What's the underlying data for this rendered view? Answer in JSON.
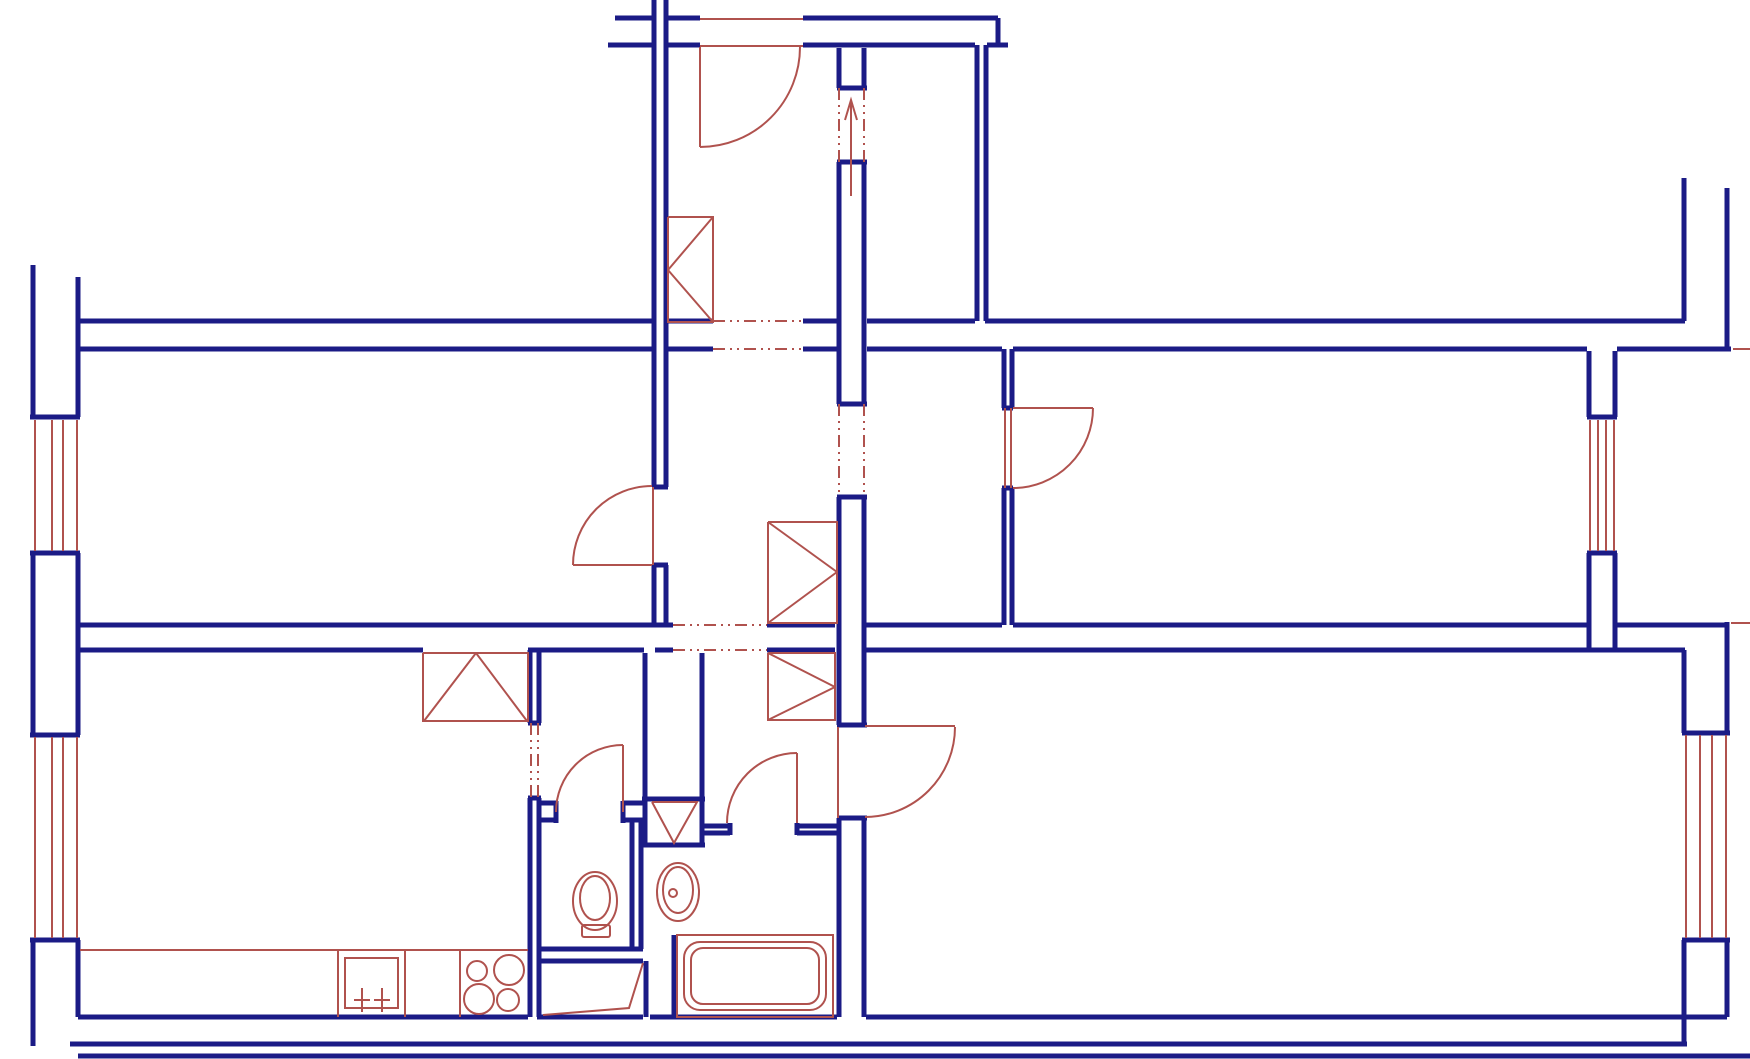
{
  "canvas": {
    "w": 1750,
    "h": 1059,
    "background": "#ffffff"
  },
  "palette": {
    "wall_color": "#1b1b86",
    "thin_color": "#b0524e",
    "wall_width": 5,
    "thin_width": 2,
    "dash_pattern": "12 5 2 5 2 5"
  },
  "plan": {
    "walls_h": [
      [
        18,
        615,
        652
      ],
      [
        18,
        668,
        700
      ],
      [
        18,
        803,
        998
      ],
      [
        45,
        608,
        652
      ],
      [
        45,
        668,
        700
      ],
      [
        45,
        803,
        975
      ],
      [
        45,
        987,
        1008
      ],
      [
        321,
        80,
        652
      ],
      [
        321,
        668,
        713
      ],
      [
        321,
        803,
        837
      ],
      [
        321,
        867,
        975
      ],
      [
        321,
        985,
        1685
      ],
      [
        349,
        80,
        652
      ],
      [
        349,
        668,
        713
      ],
      [
        349,
        803,
        837
      ],
      [
        349,
        867,
        1002
      ],
      [
        349,
        1013,
        1587
      ],
      [
        349,
        1617,
        1731
      ],
      [
        417,
        30,
        80
      ],
      [
        553,
        30,
        80
      ],
      [
        735,
        30,
        80
      ],
      [
        940,
        30,
        80
      ],
      [
        417,
        1587,
        1617
      ],
      [
        553,
        1587,
        1617
      ],
      [
        733,
        1682,
        1730
      ],
      [
        940,
        1682,
        1730
      ],
      [
        487,
        652,
        668
      ],
      [
        565,
        652,
        668
      ],
      [
        408,
        1002,
        1013
      ],
      [
        488,
        1002,
        1013
      ],
      [
        88,
        837,
        867
      ],
      [
        162,
        837,
        867
      ],
      [
        404,
        837,
        867
      ],
      [
        497,
        837,
        867
      ],
      [
        725,
        837,
        867
      ],
      [
        818,
        837,
        867
      ],
      [
        723,
        528,
        541
      ],
      [
        798,
        528,
        541
      ],
      [
        625,
        80,
        673
      ],
      [
        625,
        767,
        835
      ],
      [
        625,
        865,
        1002
      ],
      [
        625,
        1013,
        1587
      ],
      [
        625,
        1617,
        1728
      ],
      [
        650,
        80,
        423
      ],
      [
        650,
        528,
        644
      ],
      [
        650,
        655,
        673
      ],
      [
        650,
        767,
        835
      ],
      [
        650,
        865,
        1685
      ],
      [
        803,
        541,
        556
      ],
      [
        820,
        541,
        556
      ],
      [
        803,
        623,
        643
      ],
      [
        820,
        623,
        643
      ],
      [
        826,
        703,
        730
      ],
      [
        833,
        703,
        730
      ],
      [
        826,
        797,
        840
      ],
      [
        833,
        797,
        840
      ],
      [
        949,
        541,
        643
      ],
      [
        961,
        541,
        643
      ],
      [
        799,
        642,
        705
      ],
      [
        845,
        642,
        705
      ],
      [
        1017,
        78,
        528
      ],
      [
        1017,
        537,
        643
      ],
      [
        1017,
        650,
        837
      ],
      [
        1017,
        866,
        1727
      ],
      [
        1044,
        70,
        1687
      ],
      [
        1056,
        78,
        1750
      ]
    ],
    "walls_v": [
      [
        33,
        265,
        417
      ],
      [
        33,
        553,
        735
      ],
      [
        33,
        940,
        1046
      ],
      [
        78,
        277,
        417
      ],
      [
        78,
        553,
        735
      ],
      [
        78,
        940,
        1017
      ],
      [
        654,
        0,
        487
      ],
      [
        654,
        565,
        625
      ],
      [
        666,
        0,
        487
      ],
      [
        666,
        565,
        625
      ],
      [
        839,
        48,
        88
      ],
      [
        839,
        162,
        404
      ],
      [
        839,
        497,
        725
      ],
      [
        839,
        818,
        1017
      ],
      [
        864,
        48,
        88
      ],
      [
        864,
        162,
        404
      ],
      [
        864,
        497,
        725
      ],
      [
        864,
        818,
        1017
      ],
      [
        977,
        45,
        321
      ],
      [
        986,
        45,
        321
      ],
      [
        998,
        18,
        45
      ],
      [
        1004,
        349,
        408
      ],
      [
        1004,
        488,
        625
      ],
      [
        1012,
        349,
        408
      ],
      [
        1012,
        488,
        625
      ],
      [
        1589,
        351,
        417
      ],
      [
        1589,
        553,
        650
      ],
      [
        1615,
        351,
        417
      ],
      [
        1615,
        553,
        650
      ],
      [
        1684,
        178,
        321
      ],
      [
        1727,
        188,
        349
      ],
      [
        1684,
        650,
        733
      ],
      [
        1727,
        622,
        733
      ],
      [
        1684,
        940,
        1046
      ],
      [
        1727,
        940,
        1017
      ],
      [
        645,
        653,
        797
      ],
      [
        702,
        653,
        797
      ],
      [
        530,
        650,
        723
      ],
      [
        539,
        650,
        723
      ],
      [
        530,
        798,
        1017
      ],
      [
        539,
        798,
        1017
      ],
      [
        632,
        818,
        949
      ],
      [
        641,
        818,
        949
      ],
      [
        646,
        961,
        1017
      ],
      [
        674,
        935,
        1017
      ],
      [
        556,
        801,
        823
      ],
      [
        623,
        801,
        823
      ],
      [
        730,
        823,
        835
      ],
      [
        797,
        823,
        835
      ],
      [
        645,
        797,
        847
      ],
      [
        702,
        797,
        847
      ]
    ],
    "red_h": [
      [
        19,
        700,
        803
      ],
      [
        46,
        700,
        803
      ],
      [
        565,
        573,
        652
      ],
      [
        408,
        1013,
        1093
      ],
      [
        726,
        865,
        955
      ],
      [
        950,
        80,
        528
      ],
      [
        349,
        1733,
        1750
      ],
      [
        623,
        1731,
        1750
      ]
    ],
    "red_v": [
      [
        700,
        47,
        147
      ],
      [
        653,
        487,
        565
      ],
      [
        1005,
        408,
        488
      ],
      [
        1011,
        408,
        488
      ],
      [
        838,
        727,
        818
      ],
      [
        623,
        745,
        812
      ],
      [
        797,
        753,
        823
      ],
      [
        338,
        950,
        1017
      ],
      [
        405,
        950,
        1017
      ],
      [
        460,
        950,
        1017
      ],
      [
        35,
        420,
        551
      ],
      [
        52,
        420,
        551
      ],
      [
        63,
        420,
        551
      ],
      [
        77,
        420,
        551
      ],
      [
        35,
        737,
        938
      ],
      [
        52,
        737,
        938
      ],
      [
        63,
        737,
        938
      ],
      [
        77,
        737,
        938
      ],
      [
        1590,
        420,
        551
      ],
      [
        1598,
        420,
        551
      ],
      [
        1606,
        420,
        551
      ],
      [
        1614,
        420,
        551
      ],
      [
        1686,
        735,
        938
      ],
      [
        1700,
        735,
        938
      ],
      [
        1712,
        735,
        938
      ],
      [
        1726,
        735,
        938
      ]
    ],
    "dash_h": [
      [
        321,
        713,
        803
      ],
      [
        349,
        713,
        803
      ],
      [
        625,
        673,
        767
      ],
      [
        650,
        673,
        767
      ]
    ],
    "dash_v": [
      [
        839,
        88,
        162
      ],
      [
        864,
        88,
        162
      ],
      [
        839,
        404,
        497
      ],
      [
        864,
        404,
        497
      ],
      [
        531,
        723,
        798
      ],
      [
        538,
        723,
        798
      ]
    ],
    "door_arcs": [
      [
        700,
        47,
        100,
        0,
        90
      ],
      [
        652,
        565,
        79,
        180,
        270
      ],
      [
        1013,
        408,
        80,
        0,
        90
      ],
      [
        623,
        812,
        67,
        180,
        270
      ],
      [
        797,
        823,
        70,
        180,
        270
      ],
      [
        865,
        727,
        90,
        0,
        90
      ]
    ],
    "polylines": [
      [
        [
          423,
          653
        ],
        [
          528,
          653
        ],
        [
          528,
          721
        ],
        [
          423,
          721
        ],
        [
          423,
          653
        ]
      ],
      [
        [
          476,
          653
        ],
        [
          424,
          721
        ]
      ],
      [
        [
          476,
          653
        ],
        [
          527,
          721
        ]
      ],
      [
        [
          668,
          217
        ],
        [
          713,
          217
        ],
        [
          713,
          322
        ],
        [
          668,
          322
        ],
        [
          668,
          217
        ]
      ],
      [
        [
          713,
          217
        ],
        [
          668,
          270
        ]
      ],
      [
        [
          668,
          270
        ],
        [
          713,
          322
        ]
      ],
      [
        [
          768,
          522
        ],
        [
          837,
          522
        ],
        [
          837,
          623
        ],
        [
          768,
          623
        ],
        [
          768,
          522
        ]
      ],
      [
        [
          768,
          522
        ],
        [
          837,
          572
        ]
      ],
      [
        [
          768,
          623
        ],
        [
          837,
          572
        ]
      ],
      [
        [
          768,
          653
        ],
        [
          835,
          653
        ],
        [
          835,
          720
        ],
        [
          768,
          720
        ],
        [
          768,
          653
        ]
      ],
      [
        [
          768,
          653
        ],
        [
          835,
          687
        ]
      ],
      [
        [
          768,
          720
        ],
        [
          835,
          687
        ]
      ],
      [
        [
          652,
          802
        ],
        [
          697,
          802
        ],
        [
          674,
          843
        ],
        [
          652,
          802
        ]
      ],
      [
        [
          543,
          1015
        ],
        [
          629,
          1008
        ],
        [
          643,
          963
        ]
      ],
      [
        [
          362,
          988
        ],
        [
          362,
          1012
        ]
      ],
      [
        [
          382,
          988
        ],
        [
          382,
          1012
        ]
      ],
      [
        [
          354,
          1000
        ],
        [
          370,
          1000
        ]
      ],
      [
        [
          374,
          1000
        ],
        [
          390,
          1000
        ]
      ],
      [
        [
          845,
          120
        ],
        [
          851,
          100
        ],
        [
          857,
          120
        ]
      ],
      [
        [
          851,
          100
        ],
        [
          851,
          196
        ]
      ]
    ],
    "rects": [
      [
        345,
        958,
        53,
        50,
        0
      ],
      [
        677,
        935,
        156,
        82,
        0
      ],
      [
        684,
        942,
        142,
        68,
        16
      ],
      [
        691,
        948,
        128,
        56,
        12
      ],
      [
        582,
        925,
        28,
        12,
        2
      ]
    ],
    "ellipses": [
      [
        595,
        901,
        22,
        29
      ],
      [
        595,
        898,
        15,
        22
      ],
      [
        678,
        892,
        21,
        29
      ],
      [
        678,
        890,
        15,
        23
      ]
    ],
    "circles": [
      [
        673,
        893,
        4
      ],
      [
        477,
        971,
        10
      ],
      [
        509,
        970,
        15
      ],
      [
        479,
        999,
        15
      ],
      [
        508,
        1000,
        11
      ]
    ]
  }
}
